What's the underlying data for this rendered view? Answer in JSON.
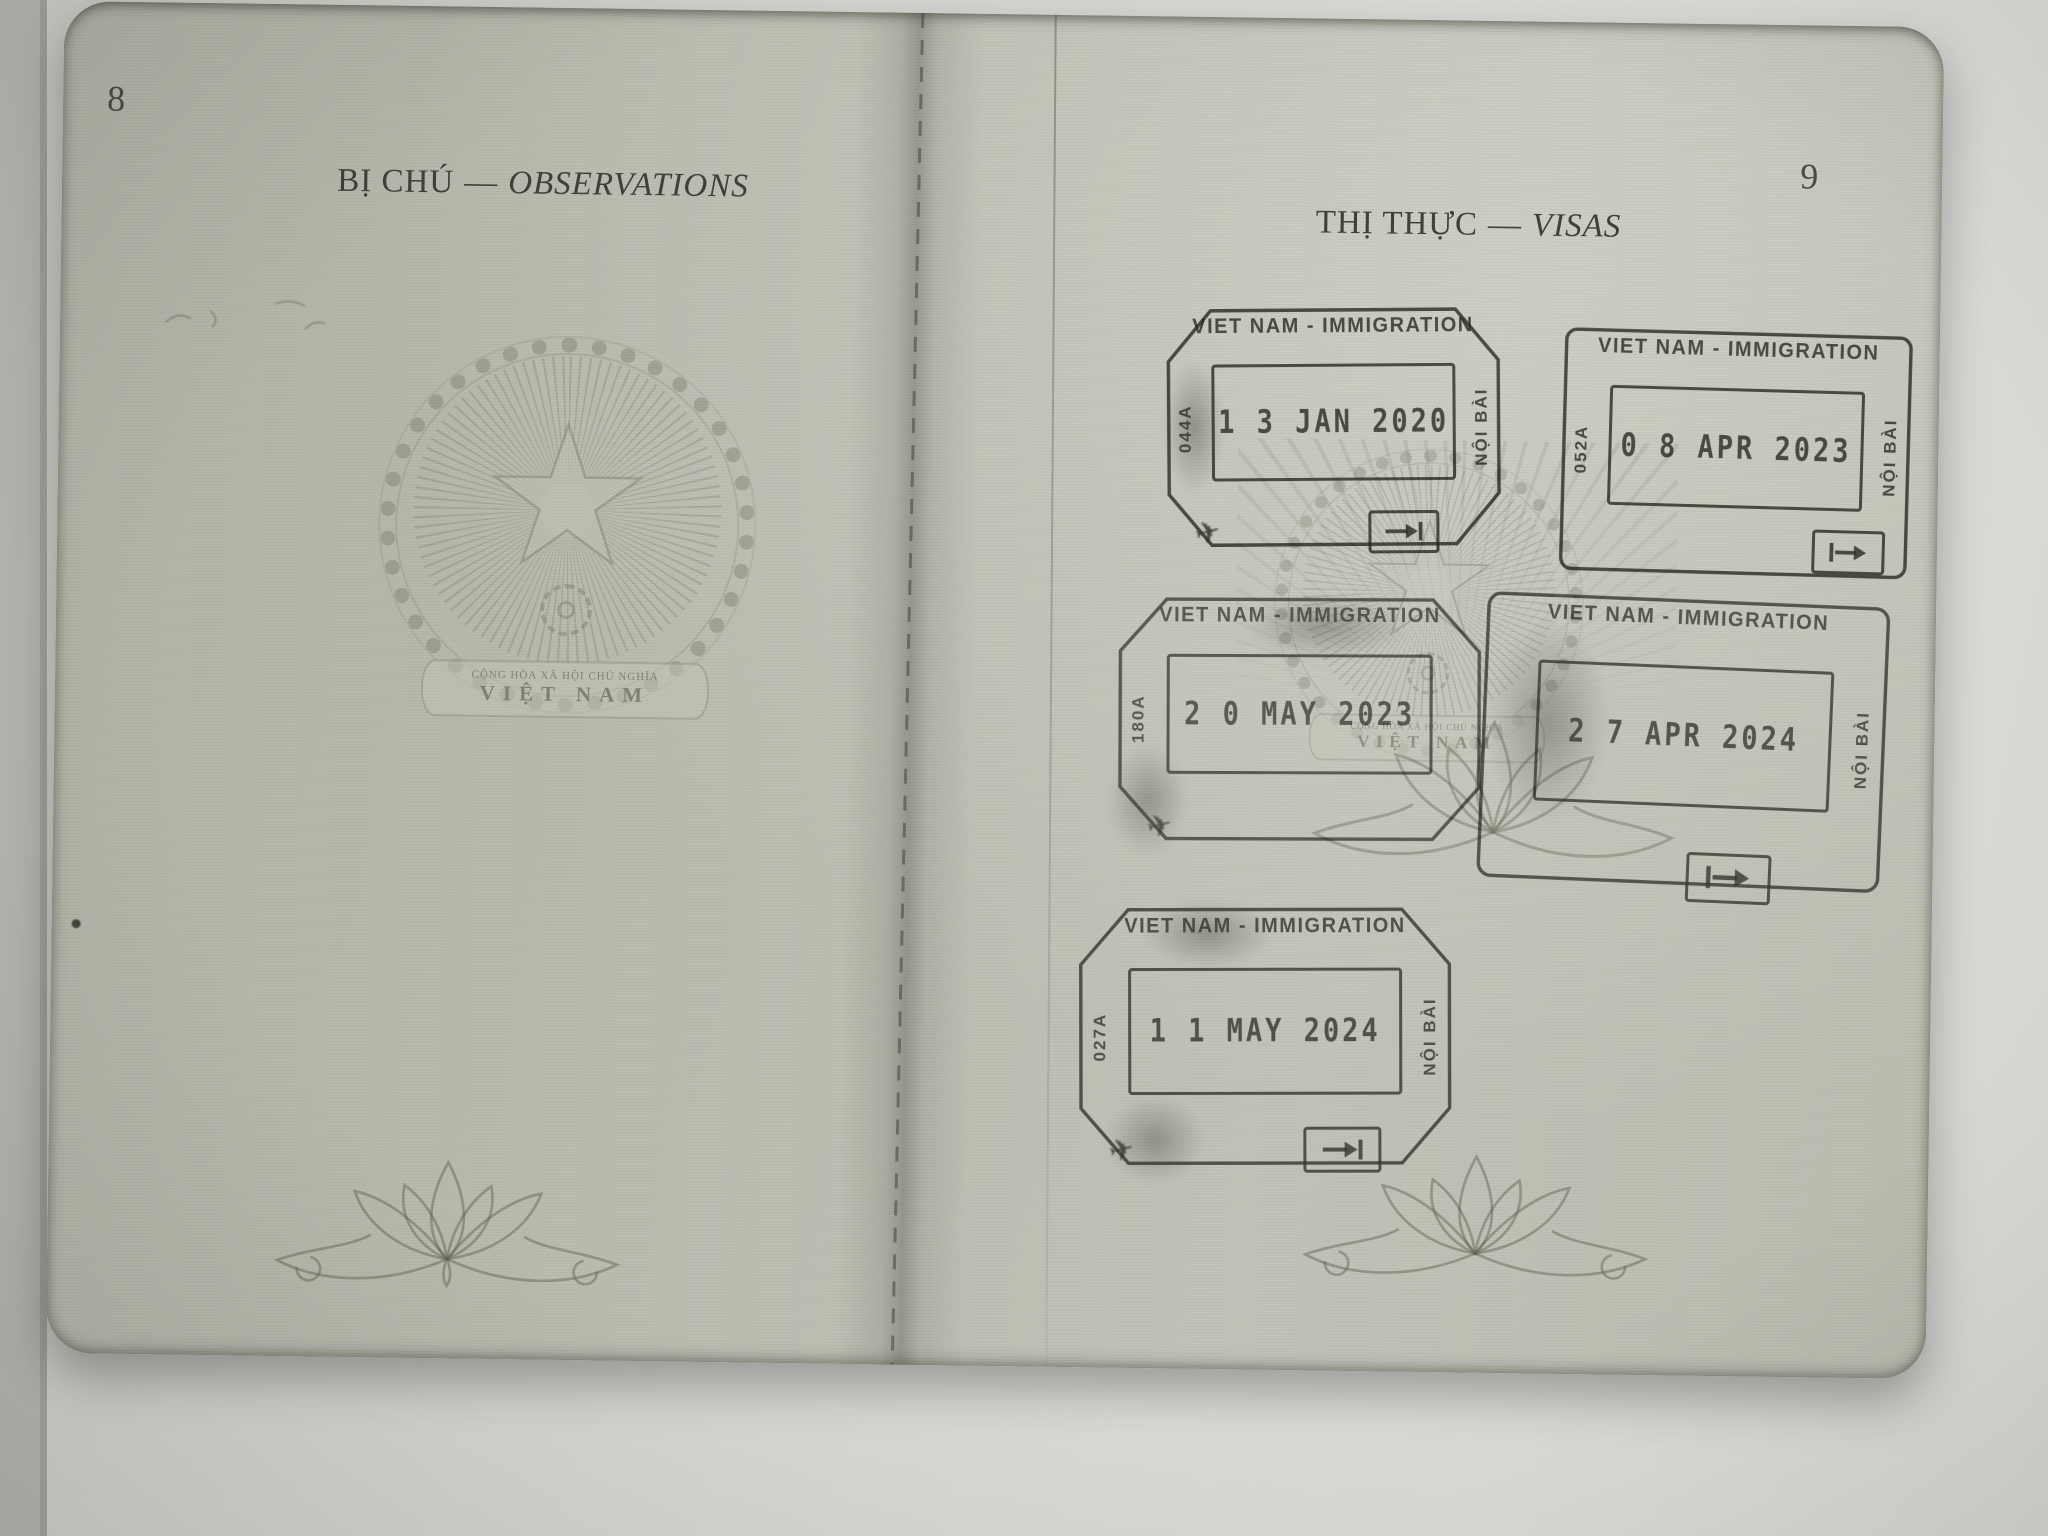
{
  "document": "passport-inner-spread-photo",
  "page_left": {
    "page_number": "8",
    "title_vi": "BỊ CHÚ",
    "title_separator": "—",
    "title_en": "OBSERVATIONS",
    "emblem_motto_line1": "CỘNG HÒA XÃ HỘI CHỦ NGHĨA",
    "emblem_motto_line2": "VIỆT NAM"
  },
  "page_right": {
    "page_number": "9",
    "title_vi": "THỊ THỰC",
    "title_separator": "—",
    "title_en": "VISAS",
    "emblem_motto_line1": "CỘNG HÒA XÃ HỘI CHỦ NGHĨA",
    "emblem_motto_line2": "VIỆT NAM",
    "stamps": [
      {
        "header": "VIET NAM - IMMIGRATION",
        "date": "1 3 JAN 2020",
        "left_code": "044A",
        "right_text": "NỘI BÀI"
      },
      {
        "header": "VIET NAM - IMMIGRATION",
        "date": "0 8 APR 2023",
        "left_code": "052A",
        "right_text": "NỘI BÀI"
      },
      {
        "header": "VIET NAM - IMMIGRATION",
        "date": "2 0 MAY 2023",
        "left_code": "180A",
        "right_text": ""
      },
      {
        "header": "VIET NAM - IMMIGRATION",
        "date": "2 7 APR 2024",
        "left_code": "",
        "right_text": "NỘI BÀI"
      },
      {
        "header": "VIET NAM - IMMIGRATION",
        "date": "1 1 MAY 2024",
        "left_code": "027A",
        "right_text": "NỘI BÀI"
      }
    ]
  },
  "colors": {
    "paper": "#babcb0",
    "surface": "#d7d5d1",
    "heading_ink": "#3c413a",
    "stamp_ink": "#383b34"
  }
}
